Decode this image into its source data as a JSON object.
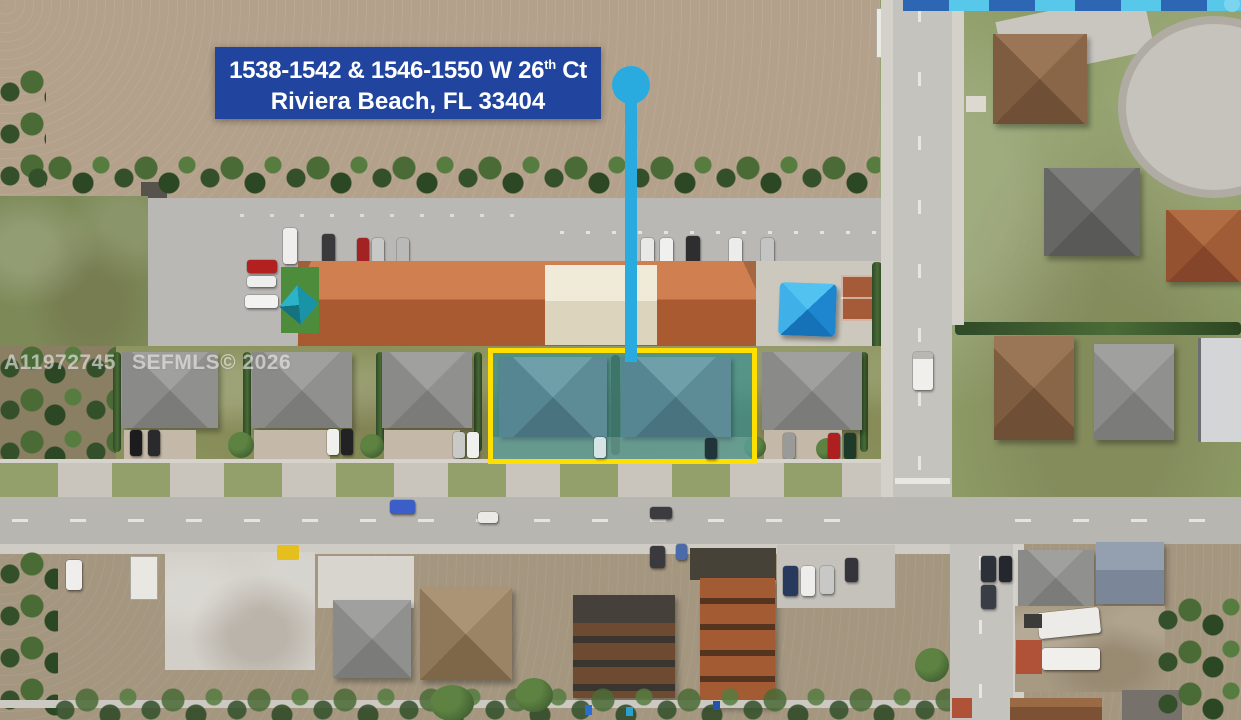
{
  "photo": {
    "address_banner": {
      "line1_pre": "1538-1542 & 1546-1550 W 26",
      "line1_sup": "th",
      "line1_post": " Ct",
      "line2": "Riviera Beach, FL 33404",
      "bg_color": "#21459e",
      "text_color": "#ffffff"
    },
    "marker": {
      "icon": "location-pin",
      "color": "#2aabdf"
    },
    "subject_property_highlight": {
      "border_color": "#ffdf00",
      "fill_color": "rgba(27,142,162,0.52)"
    },
    "watermark": {
      "mls_id": "A11972745",
      "source": "SEFMLS© 2026"
    },
    "photo_strip_colors": [
      "#2d66b3",
      "#57c7ea"
    ]
  }
}
